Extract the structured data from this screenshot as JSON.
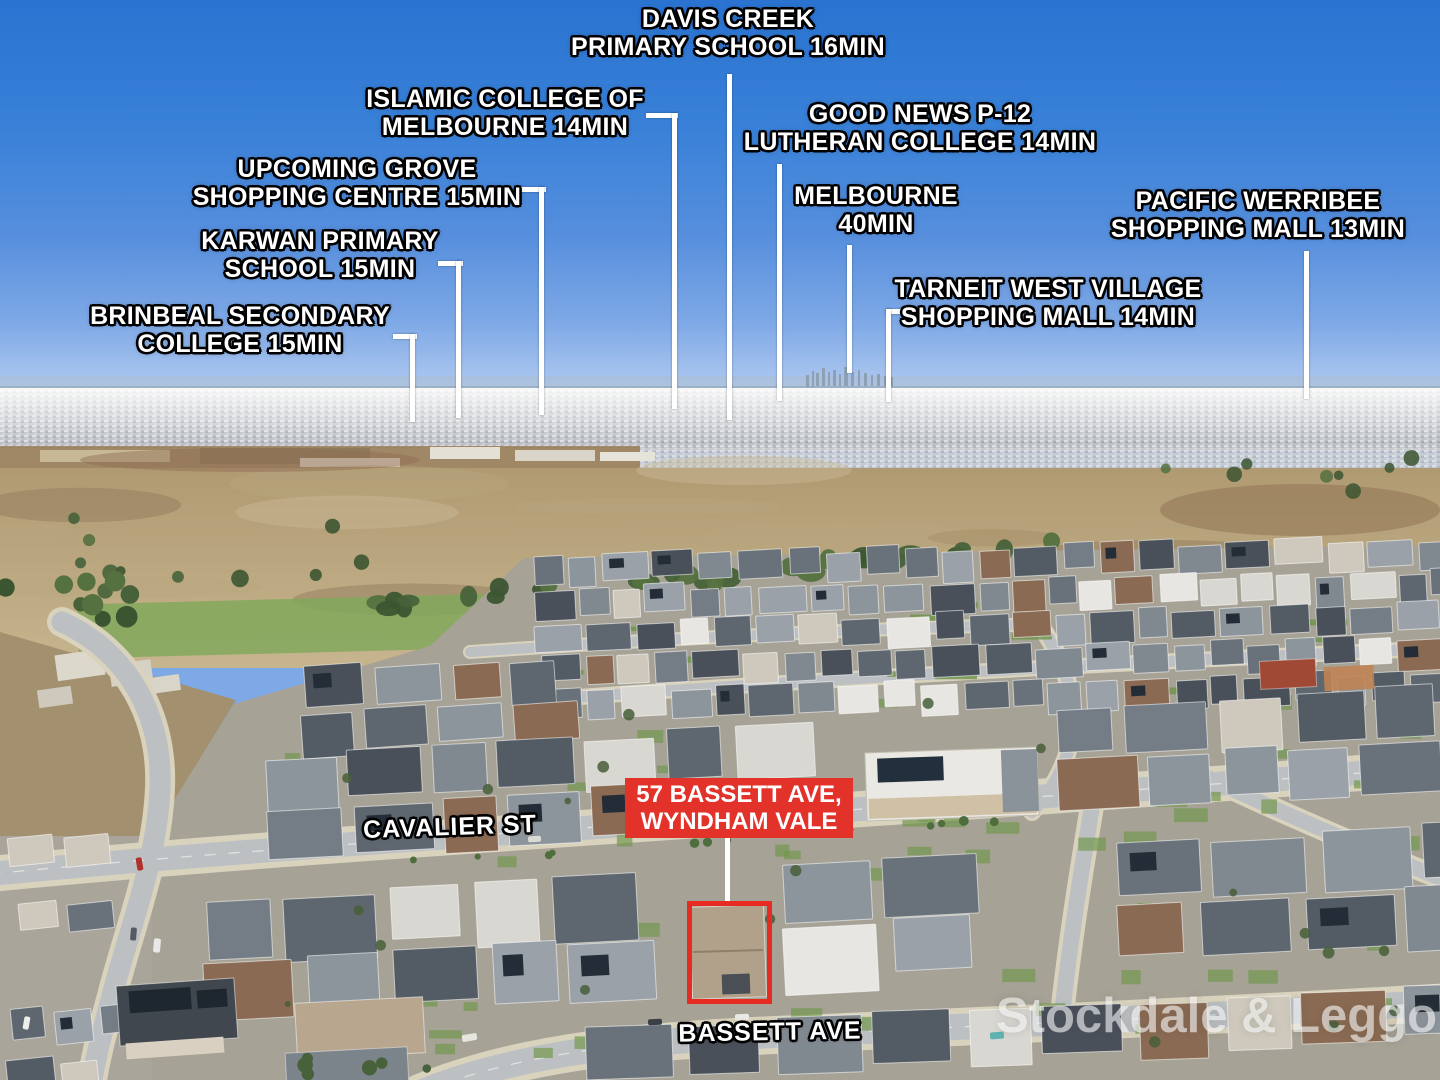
{
  "annotations": {
    "locations": [
      {
        "name": "davis-creek-primary-school",
        "line1": "DAVIS CREEK",
        "line2": "PRIMARY SCHOOL 16MIN"
      },
      {
        "name": "islamic-college-of-melbourne",
        "line1": "ISLAMIC COLLEGE OF",
        "line2": "MELBOURNE 14MIN"
      },
      {
        "name": "upcoming-grove-shopping",
        "line1": "UPCOMING GROVE",
        "line2": "SHOPPING CENTRE 15MIN"
      },
      {
        "name": "karwan-primary-school",
        "line1": "KARWAN PRIMARY",
        "line2": "SCHOOL 15MIN"
      },
      {
        "name": "brinbeal-secondary-college",
        "line1": "BRINBEAL SECONDARY",
        "line2": "COLLEGE 15MIN"
      },
      {
        "name": "good-news-lutheran-college",
        "line1": "GOOD NEWS P-12",
        "line2": "LUTHERAN COLLEGE 14MIN"
      },
      {
        "name": "melbourne-cbd",
        "line1": "MELBOURNE",
        "line2": "40MIN"
      },
      {
        "name": "tarneit-west-village",
        "line1": "TARNEIT WEST VILLAGE",
        "line2": "SHOPPING MALL 14MIN"
      },
      {
        "name": "pacific-werribee",
        "line1": "PACIFIC WERRIBEE",
        "line2": "SHOPPING MALL 13MIN"
      }
    ],
    "property": {
      "line1": "57 BASSETT AVE,",
      "line2": "WYNDHAM VALE"
    },
    "streets": {
      "cavalier": "CAVALIER ST",
      "bassett": "BASSETT AVE"
    },
    "watermark": "Stockdale & Leggo",
    "colors": {
      "marker_red": "#e2322a",
      "outline_red": "#e52b22",
      "line_white": "#ffffff"
    }
  }
}
